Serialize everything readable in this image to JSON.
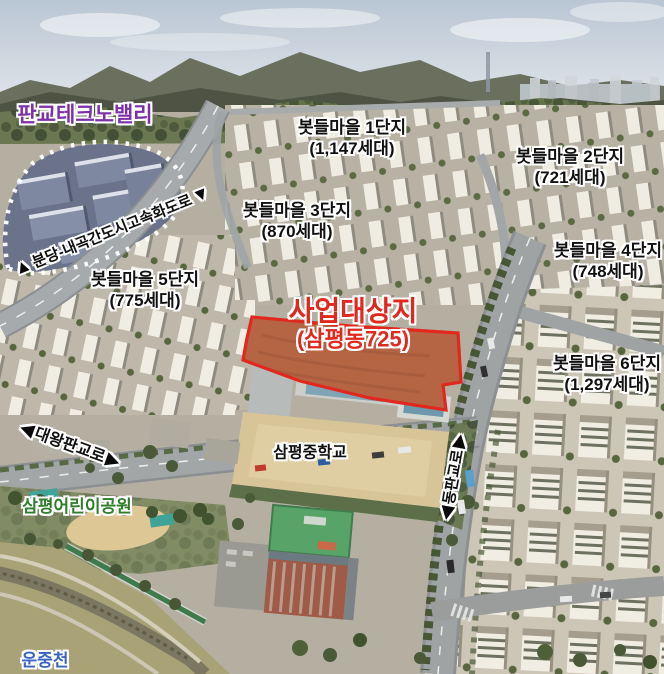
{
  "map": {
    "areas": {
      "technovalley": {
        "label": "판교테크노밸리",
        "color": "#7d2fa8"
      },
      "site": {
        "label": "사업대상지",
        "sublabel": "(삼평동725)",
        "color": "#e0281e"
      },
      "school": {
        "label": "삼평중학교",
        "color": "#111111"
      },
      "park": {
        "label": "삼평어린이공원",
        "color": "#2e7d2a"
      },
      "stream": {
        "label": "운중천",
        "color": "#3b64c0"
      }
    },
    "roads": [
      {
        "label": "분당-내곡간도시고속화도로",
        "arrow_start": "▲",
        "arrow_end": "▼"
      },
      {
        "label": "대왕판교로",
        "arrow_start": "◀",
        "arrow_end": "▶"
      },
      {
        "label": "동판교로",
        "arrow_start": "◀",
        "arrow_end": "▶"
      }
    ],
    "complexes": [
      {
        "name": "봇들마을 1단지",
        "households": "(1,147세대)"
      },
      {
        "name": "봇들마을 2단지",
        "households": "(721세대)"
      },
      {
        "name": "봇들마을 3단지",
        "households": "(870세대)"
      },
      {
        "name": "봇들마을 4단지",
        "households": "(748세대)"
      },
      {
        "name": "봇들마을 5단지",
        "households": "(775세대)"
      },
      {
        "name": "봇들마을 6단지",
        "households": "(1,297세대)"
      }
    ]
  }
}
